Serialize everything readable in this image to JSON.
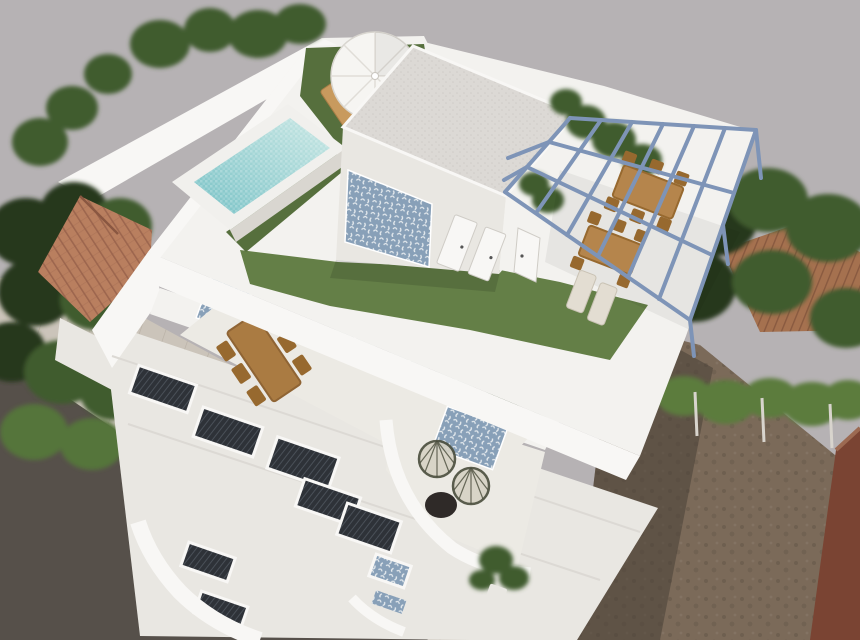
{
  "meta": {
    "type": "3d-architectural-render",
    "subject": "Aerial three-quarter view of a modern white two-storey villa with rooftop pool, white parasol lounge, penthouse with azulejo tile accent wall, steel pergola dining terrace, middle-floor terrace with wooden dining table, lower terrace with wicker egg chairs, street facade with dark railed windows, neighbouring terracotta-roof houses, trees, sidewalk, asphalt road and a bare dirt lot",
    "visible_text": "none"
  },
  "palette": {
    "backdrop": "#b6b2b4",
    "sidewalk": "#cbc4ba",
    "sidewalk_line": "#b7afa4",
    "asphalt": "#56504a",
    "dirt": "#7b6a59",
    "dirt_shadow": "#483f37",
    "red_wall": "#7a4433",
    "red_wall_top": "#9c6a52",
    "wall_bright": "#f8f7f5",
    "wall_white": "#f3f2ef",
    "wall_mid": "#e9e7e2",
    "wall_shade": "#d9d6d0",
    "terrace_floor": "#eceae4",
    "glass": "#ccd2d1",
    "window_dark": "#2e3238",
    "window_bar": "#4a5058",
    "turf": "#647f47",
    "turf_dark": "#566f3d",
    "tree_dark": "#26381e",
    "tree_mid": "#3f5c2e",
    "tree_light": "#55743a",
    "hedge": "#5b7b3e",
    "terracotta": "#b97f5f",
    "terracotta_line": "#96604a",
    "terracotta_right": "#a5714f",
    "terracotta_right_line": "#82543c",
    "pool_curb": "#f1f0ed",
    "pool_light": "#c9e7e4",
    "pool_deep": "#79c2c6",
    "azulejo_base": "#88a0b8",
    "azulejo_mark": "#f2f4f6",
    "pergola_steel": "#7e94b7",
    "wood": "#b5854c",
    "wood_dark": "#97692f",
    "wood_table2": "#aa7b42",
    "lounger": "#c89a5e",
    "cushion": "#e3ddd2",
    "gravel_base": "#dcd9d5",
    "gravel_dot": "#cfccc8",
    "chair_wire": "#4a4d3c",
    "chair_seat": "#d6d2c4",
    "dark_table": "#2f2a28",
    "umbrella": "#f6f5f2",
    "umbrella_rib": "#e0ddd7",
    "shadow": "#000000"
  },
  "legend": [
    {
      "name": "rooftop-pool",
      "desc": "raised rectangular pool with turquoise mosaic water"
    },
    {
      "name": "umbrella",
      "desc": "white parasol over two wooden sun loungers on turf"
    },
    {
      "name": "penthouse",
      "desc": "white roof room with gravel flat roof, azulejo accent wall and doors"
    },
    {
      "name": "pergola-frame",
      "desc": "steel-blue pergola grid over rooftop dining terrace"
    },
    {
      "name": "rooftop-turf",
      "desc": "artificial grass areas on roof deck"
    },
    {
      "name": "middle-terrace",
      "desc": "first floor terrace with long wooden dining table and glass doors"
    },
    {
      "name": "egg-chair-terrace",
      "desc": "lower terrace with two wicker egg chairs, round dark table, potted palm"
    },
    {
      "name": "street-facade",
      "desc": "white facade with dark railed window openings and curved balconies"
    },
    {
      "name": "left-neighbour-roof",
      "desc": "terracotta hip roof among trees"
    },
    {
      "name": "right-neighbour-roof",
      "desc": "terracotta roof behind dense trees and hedge"
    },
    {
      "name": "sidewalk",
      "desc": "pale paved sidewalk along the street"
    },
    {
      "name": "road",
      "desc": "dark asphalt road at lower left"
    },
    {
      "name": "dirt-lot",
      "desc": "bare brown lot at lower right, partly in shadow"
    },
    {
      "name": "red-wall",
      "desc": "reddish-brown neighbouring wall at far right"
    }
  ]
}
